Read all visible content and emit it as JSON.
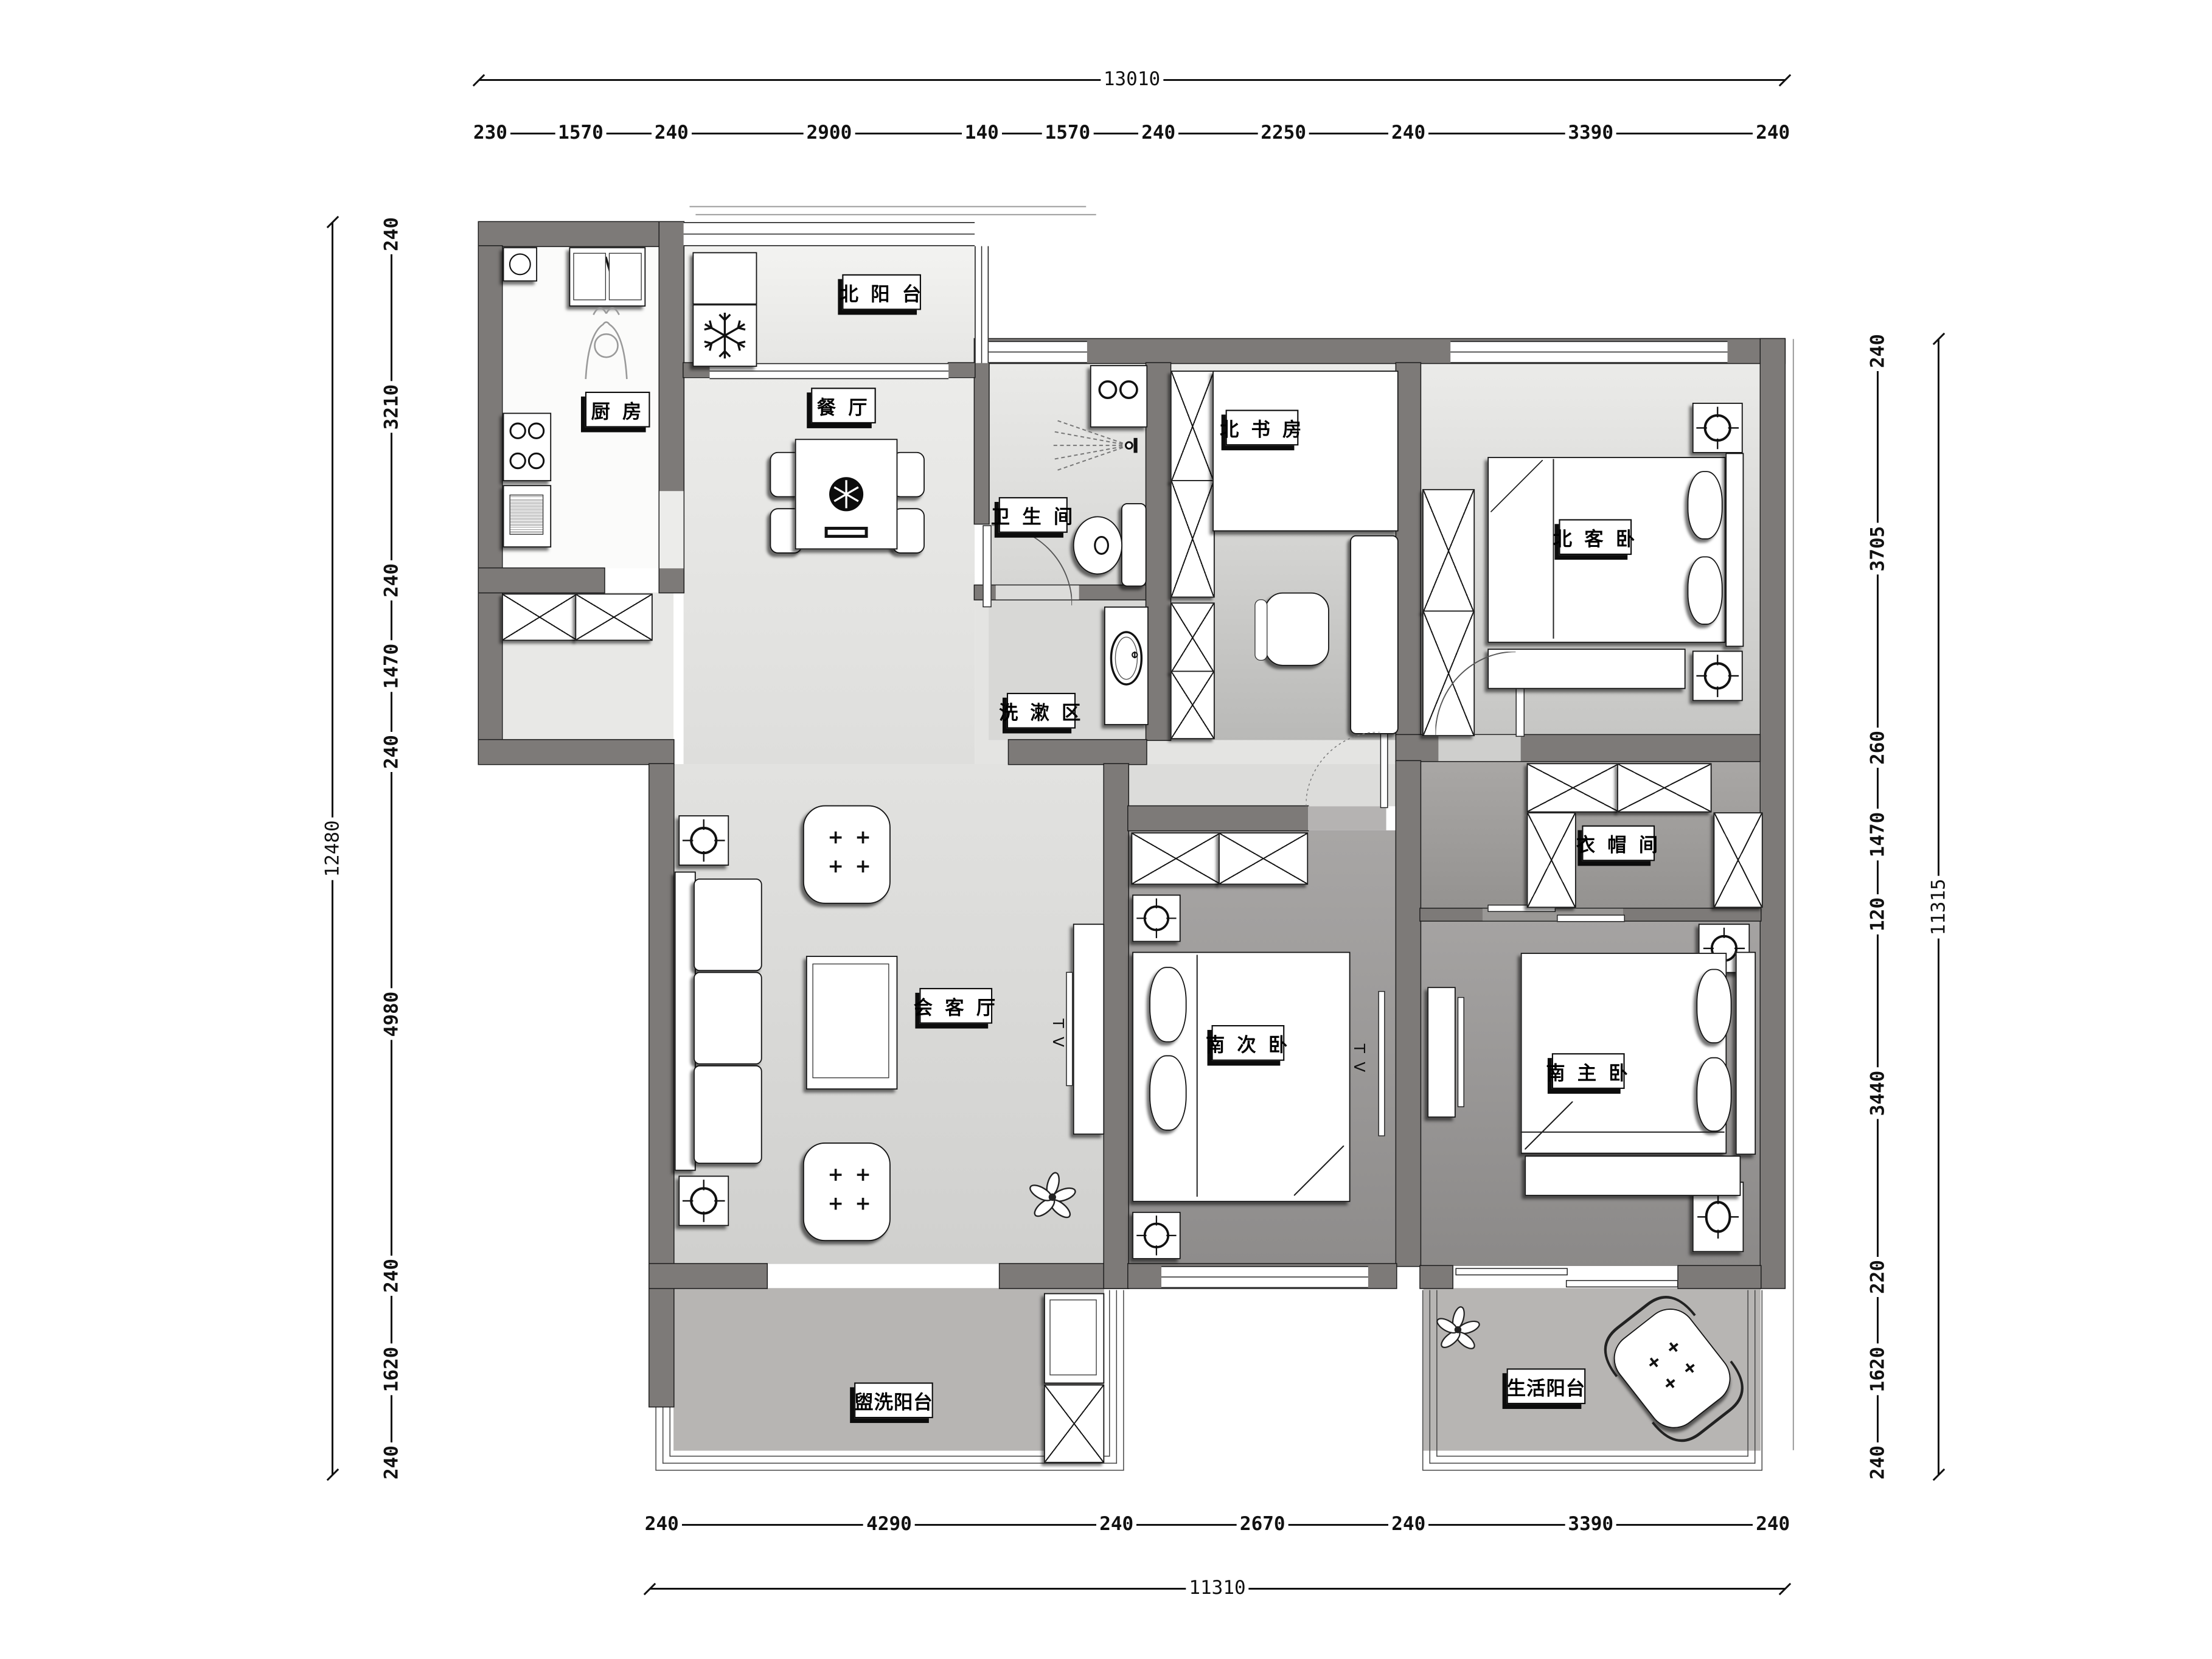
{
  "title": "apartment-floor-plan",
  "labels": {
    "north_balcony": "北 阳 台",
    "kitchen": "厨  房",
    "dining": "餐  厅",
    "bathroom": "卫 生 间",
    "wash_area": "洗 漱 区",
    "north_study": "北 书 房",
    "north_guest_bedroom": "北 客 卧",
    "cloakroom": "衣 帽 间",
    "living_room": "会 客 厅",
    "south_second_bedroom": "南 次 卧",
    "south_master_bedroom": "南 主 卧",
    "laundry_balcony": "盥洗阳台",
    "life_balcony": "生活阳台"
  },
  "annotations": {
    "tv": "T V"
  },
  "dimensions": {
    "top": {
      "total": "13010",
      "chain": [
        "230",
        "1570",
        "240",
        "2900",
        "140",
        "1570",
        "240",
        "2250",
        "240",
        "3390",
        "240"
      ]
    },
    "left": {
      "total": "12480",
      "chain": [
        "240",
        "3210",
        "240",
        "1470",
        "240",
        "4980",
        "240",
        "1620",
        "240"
      ]
    },
    "right": {
      "total": "11315",
      "chain": [
        "240",
        "3705",
        "260",
        "1470",
        "120",
        "3440",
        "220",
        "1620",
        "240"
      ]
    },
    "bottom": {
      "total": "11310",
      "chain": [
        "240",
        "4290",
        "240",
        "2670",
        "240",
        "3390",
        "240"
      ]
    }
  },
  "colors": {
    "wall": "#7d7a78",
    "floor_public": "#e3e3e1",
    "floor_bedroom_south": "#908e8d",
    "floor_balcony": "#b7b5b3",
    "line": "#111111"
  }
}
